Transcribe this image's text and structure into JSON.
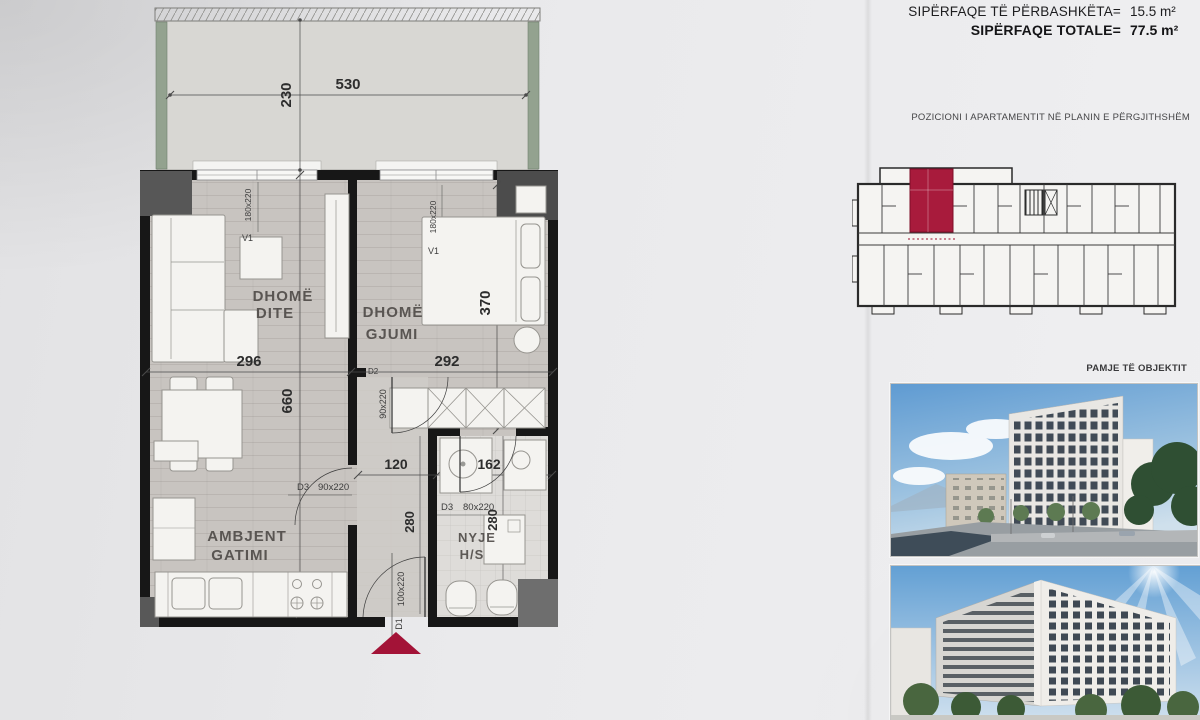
{
  "header": {
    "common_label": "SIPËRFAQE TË PËRBASHKËTA=",
    "common_value": "15.5 m²",
    "total_label": "SIPËRFAQE TOTALE=",
    "total_value": "77.5 m²"
  },
  "position": {
    "title": "POZICIONI I APARTAMENTIT NË PLANIN E PËRGJITHSHËM"
  },
  "views": {
    "title": "PAMJE TË OBJEKTIT"
  },
  "plan": {
    "balcony": {
      "width": "530",
      "depth": "230"
    },
    "living": {
      "line1": "DHOMË",
      "line2": "DITE",
      "width": "296"
    },
    "bedroom": {
      "line1": "DHOMË",
      "line2": "GJUMI",
      "width": "292",
      "depth": "370"
    },
    "kitchen": {
      "line1": "AMBJENT",
      "line2": "GATIMI",
      "height": "660"
    },
    "bath": {
      "line1": "NYJE",
      "line2": "H/S",
      "width": "162",
      "depth": "280"
    },
    "hall": {
      "width": "120",
      "depth": "280"
    },
    "doors": {
      "entry_id": "D1",
      "entry_size": "100x220",
      "bedroom_id": "D2",
      "bedroom_size": "90x220",
      "kitchen_id": "D3",
      "kitchen_size": "90x220",
      "bath_id": "D3",
      "bath_size": "80x220"
    },
    "windows": {
      "living_id": "V1",
      "living_size": "180x220",
      "bedroom_id": "V1",
      "bedroom_size": "180x220"
    }
  },
  "colors": {
    "highlight_red": "#a81b3c",
    "wall_black": "#171717",
    "floor_gray": "#c8c4c0"
  }
}
